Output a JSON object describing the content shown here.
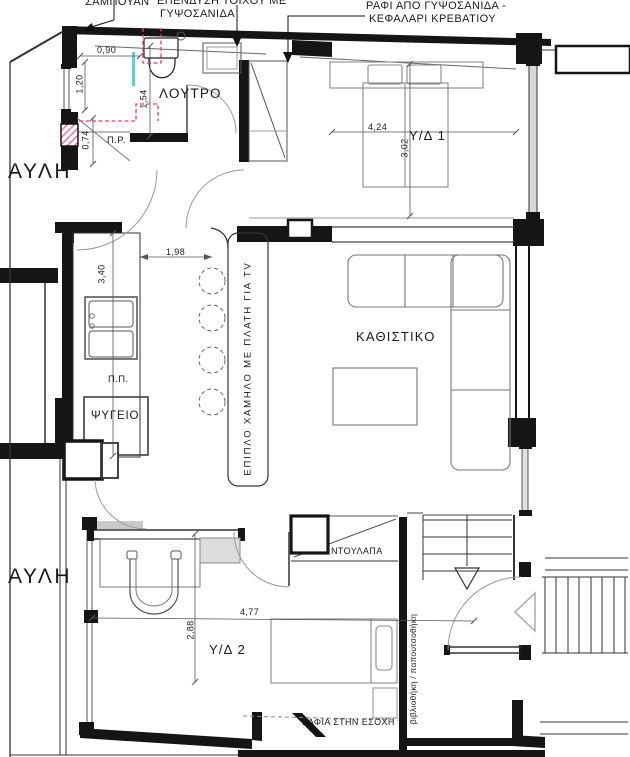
{
  "plan": {
    "callouts": {
      "shampoo": "ΣΑΜΠΟΥΑΝ",
      "cladding_l1": "ΕΠΕΝΔΥΣΗ ΤΟΙΧΟΥ ΜΕ",
      "cladding_l2": "ΓΥΨΟΣΑΝΙΔΑ",
      "headboard_l1": "ΡΑΦΙ ΑΠΟ ΓΥΨΟΣΑΝΙΔΑ -",
      "headboard_l2": "ΚΕΦΑΛΑΡΙ ΚΡΕΒΑΤΙΟΥ",
      "tv_unit": "ΕΠΙΠΛΟ ΧΑΜΗΛΟ ΜΕ ΠΛΑΤΗ ΓΙΑ TV",
      "bookshelf": "βιβλιοθήκη / παπουτσοθήκη",
      "recess_shelves": "ΡΑΦΙΑ ΣΤΗΝ ΕΣΟΧΗ",
      "wardrobe": "ΝΤΟΥΛΑΠΑ",
      "fridge": "ΨΥΓΕΙΟ",
      "pr": "Π.Ρ.",
      "pp": "Π.Π."
    },
    "rooms": {
      "bathroom": "ΛΟΥΤΡΟ",
      "bedroom1": "Υ/Δ 1",
      "bedroom2": "Υ/Δ 2",
      "living": "ΚΑΘΙΣΤΙΚΟ",
      "courtyard_upper": "ΑΥΛΗ",
      "courtyard_lower": "ΑΥΛΗ"
    },
    "dimensions": {
      "shower_width": "0,90",
      "bath_left": "1,20",
      "bath_depth": "1,54",
      "shaft_width": "0,74",
      "kitchen_length": "3,40",
      "kitchen_gap": "1,98",
      "bedroom1_width": "4,24",
      "bedroom1_depth": "3,02",
      "bedroom2_width": "4,77",
      "bedroom2_depth": "2,88"
    },
    "colors": {
      "wall": "#151515",
      "furniture": "#8a8a8a",
      "dim_line": "#555555",
      "plumbing_dashed": "#e2437a",
      "glass_accent": "#6fc9cc",
      "hatch_pink": "#ef5f93"
    }
  }
}
